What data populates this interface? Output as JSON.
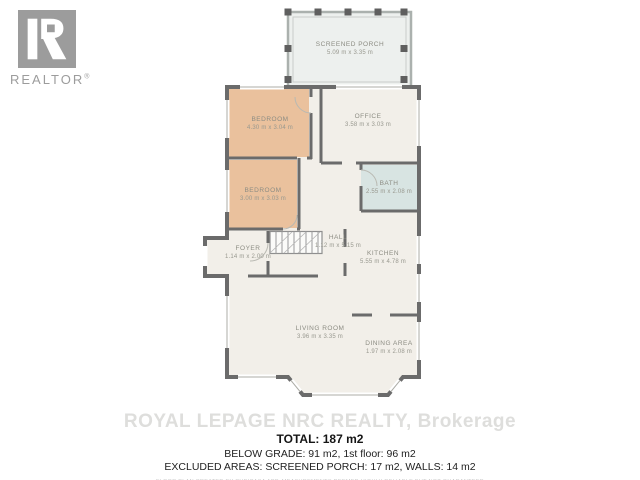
{
  "logo": {
    "brand": "REALTOR",
    "registered": "®"
  },
  "floorplan": {
    "rooms": [
      {
        "id": "screened-porch",
        "name": "SCREENED PORCH",
        "dims": "5.09 m x 3.35 m"
      },
      {
        "id": "bedroom-1",
        "name": "BEDROOM",
        "dims": "4.30 m x 3.04 m"
      },
      {
        "id": "office",
        "name": "OFFICE",
        "dims": "3.58 m x 3.03 m"
      },
      {
        "id": "bedroom-2",
        "name": "BEDROOM",
        "dims": "3.00 m x 3.03 m"
      },
      {
        "id": "bath",
        "name": "BATH",
        "dims": "2.55 m x 2.08 m"
      },
      {
        "id": "foyer",
        "name": "FOYER",
        "dims": "1.14 m x 2.00 m"
      },
      {
        "id": "hall",
        "name": "HALL",
        "dims": "1.12 m x 5.15 m"
      },
      {
        "id": "kitchen",
        "name": "KITCHEN",
        "dims": "5.55 m x 4.78 m"
      },
      {
        "id": "living-room",
        "name": "LIVING ROOM",
        "dims": "3.96 m x 3.35 m"
      },
      {
        "id": "dining-area",
        "name": "DINING AREA",
        "dims": "1.97 m x 2.08 m"
      }
    ],
    "colors": {
      "wall": "#6b6b6b",
      "floor": "#f2efe9",
      "bedroom_fill": "#eac19d",
      "bath_fill": "#d8e4e2",
      "porch_fill": "#edf0ee",
      "label_text": "#8c8c83"
    }
  },
  "watermark": "ROYAL LEPAGE NRC REALTY, Brokerage",
  "summary": {
    "total": "TOTAL: 187 m2",
    "grade_line": "BELOW GRADE: 91 m2, 1st floor: 96 m2",
    "excluded_line": "EXCLUDED AREAS: SCREENED PORCH: 17 m2, WALLS: 14 m2",
    "disclaimer": "FLOOR PLAN CREATED BY CUBICASA APP, MEASUREMENTS DEEMED HIGHLY RELIABLE BUT NOT GUARANTEED"
  }
}
